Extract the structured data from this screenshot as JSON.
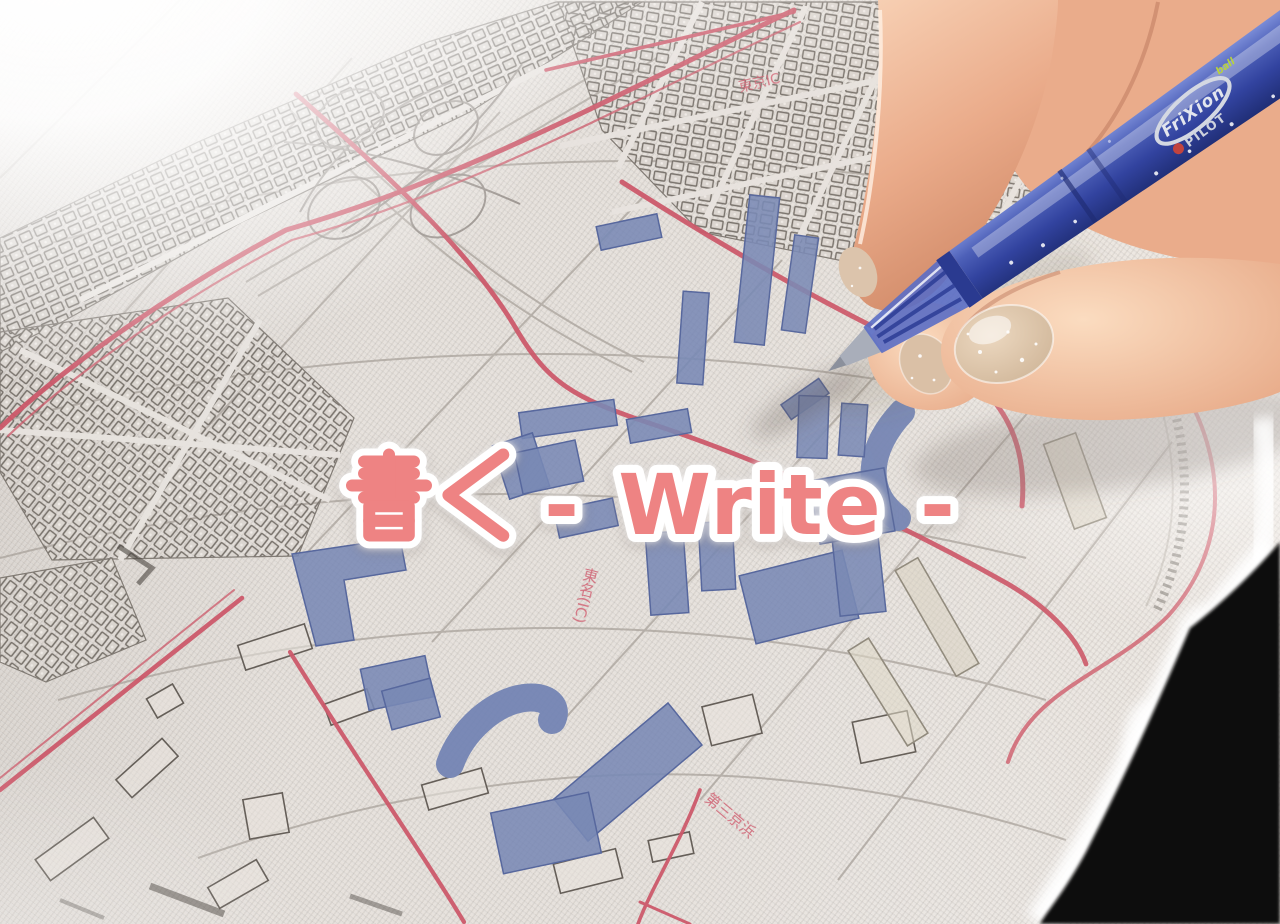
{
  "photo": {
    "description": "A hand holds a blue PILOT FriXion ball erasable pen and colors in buildings on a city street map printed on woven canvas fabric; bright sunlight washes the upper-left corner and a black background shows past the fabric edge at lower right."
  },
  "caption": {
    "full_text": "書く - Write -",
    "kanji": "書く",
    "latin": "- Write -",
    "text_color": "#ee8383",
    "outline_color": "#ffffff"
  },
  "pen": {
    "brand": "PILOT",
    "series": "FriXion",
    "series_variant": "ball",
    "body_color": "#3c4fa4",
    "ink_color": "#7183b3"
  },
  "map": {
    "fabric_color": "#e7e2dd",
    "road_color": "#cb5062",
    "line_color": "#8d8780",
    "highlight_ink_color": "#7183b3",
    "labels": [
      {
        "text": "東京IC"
      },
      {
        "text": "東名(IC)"
      },
      {
        "text": "第三京浜"
      }
    ]
  }
}
